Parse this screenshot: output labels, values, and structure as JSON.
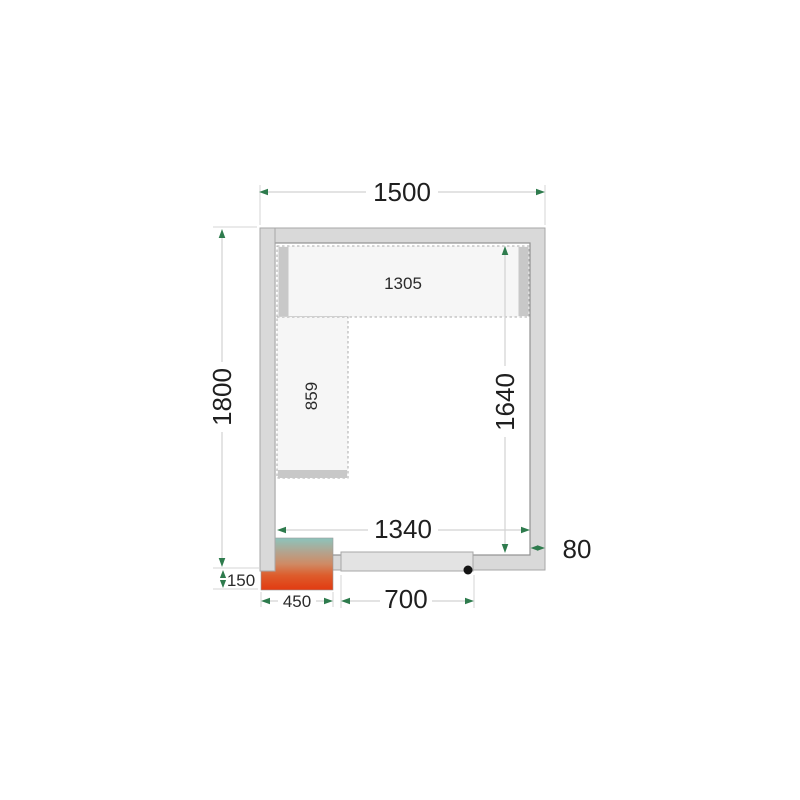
{
  "diagram": {
    "dimension_labels": {
      "outer_width": "1500",
      "outer_height": "1800",
      "inner_width": "1340",
      "inner_height": "1640",
      "wall_thickness": "80",
      "top_shelf_length": "1305",
      "left_shelf_length": "859",
      "cooling_unit_width": "450",
      "cooling_unit_protrusion": "150",
      "door_width": "700"
    },
    "colors": {
      "wall_fill": "#d9d9d9",
      "wall_border": "#a7a7a7",
      "interior_fill": "#ffffff",
      "shelf_fill": "#f6f6f6",
      "shelf_border": "#ababab",
      "shelf_support": "#c8c8c8",
      "door_fill": "#e3e3e3",
      "door_dot": "#141414",
      "dimension_arrow": "#2e7b4d",
      "dimension_line": "#d2d2d2",
      "label_text": "#1f1f1f",
      "unit_gradient_top": "#8cc4bc",
      "unit_gradient_mid": "#cf8a64",
      "unit_gradient_bottom": "#e23a10"
    }
  }
}
